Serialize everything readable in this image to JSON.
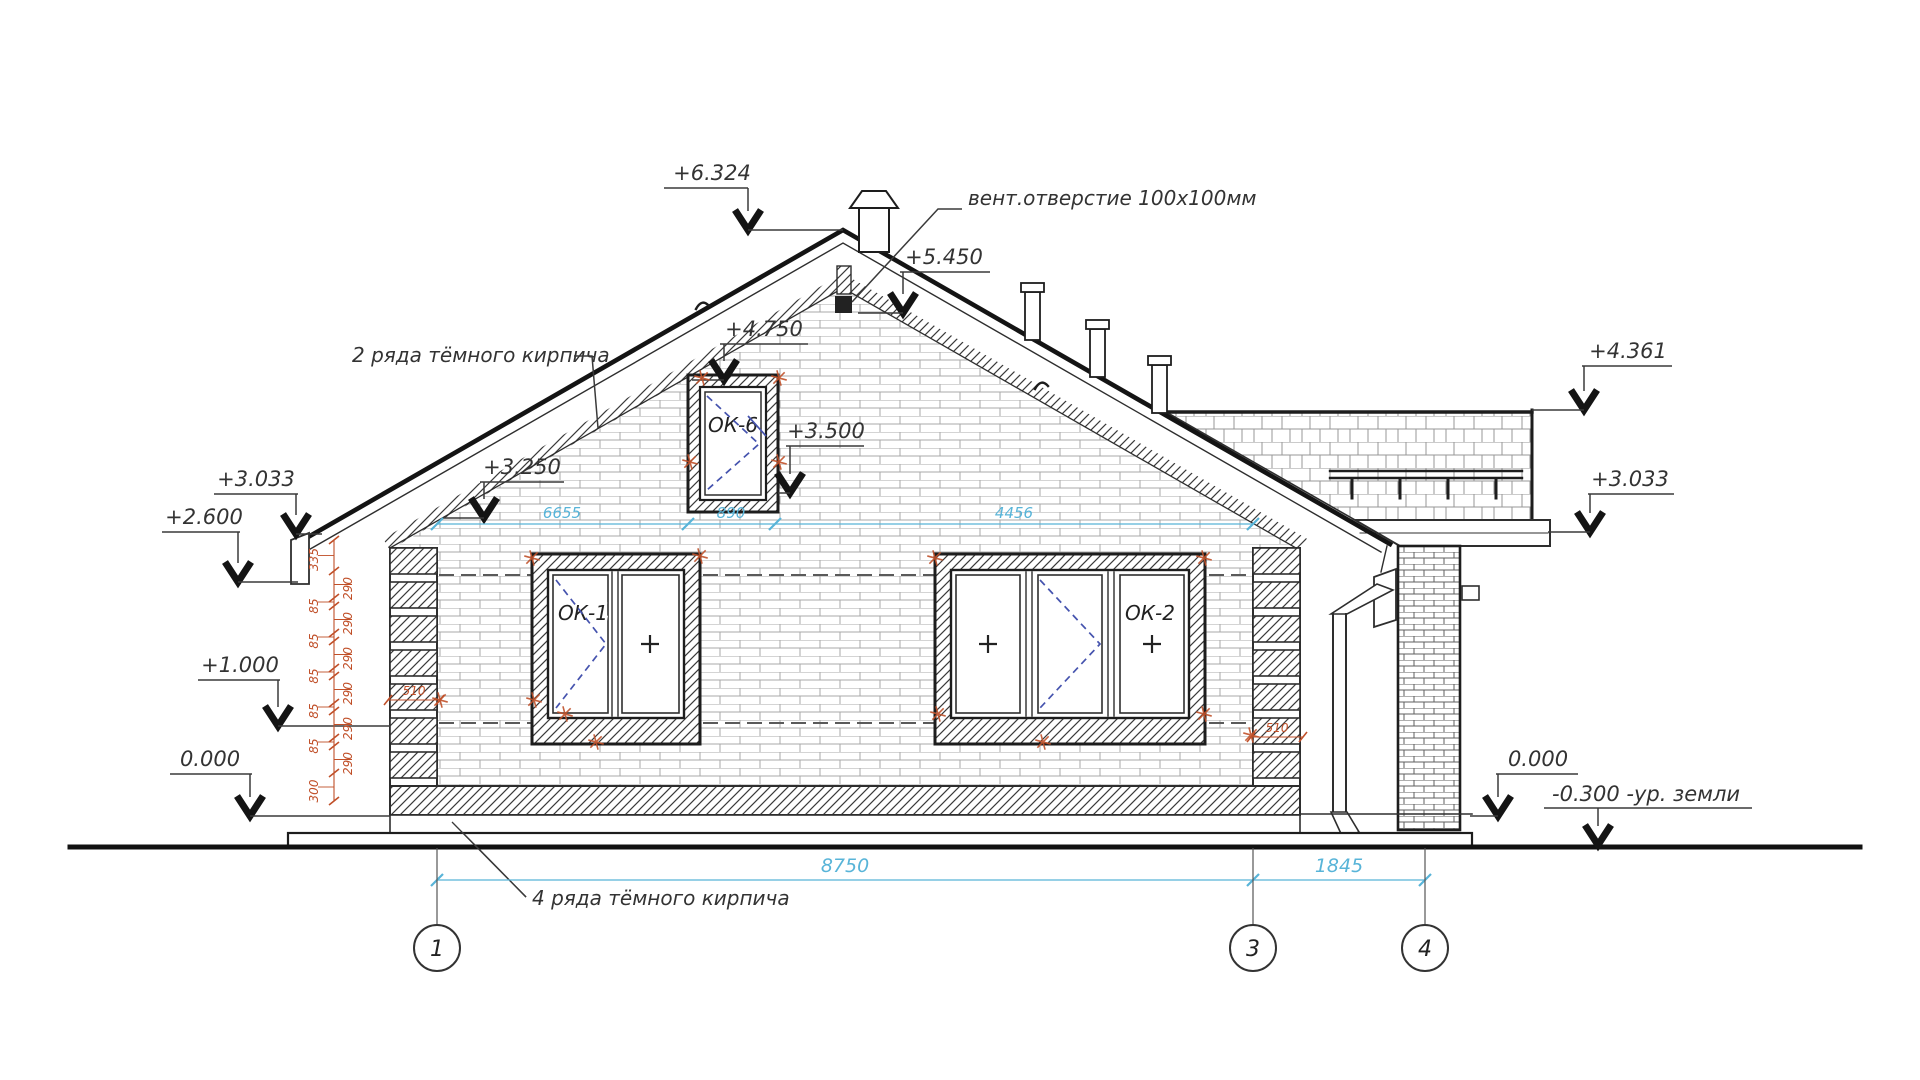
{
  "labels": {
    "vent": "вент.отверстие 100х100мм",
    "dark_brick_2": "2 ряда тёмного кирпича",
    "dark_brick_4": "4 ряда тёмного кирпича",
    "ground_level": "-0.300 -ур. земли"
  },
  "elevation_marks": [
    {
      "id": "m6324",
      "label": "+6.324"
    },
    {
      "id": "m5450",
      "label": "+5.450"
    },
    {
      "id": "m4750",
      "label": "+4.750"
    },
    {
      "id": "m3500",
      "label": "+3.500"
    },
    {
      "id": "m3250",
      "label": "+3.250"
    },
    {
      "id": "m3033L",
      "label": "+3.033"
    },
    {
      "id": "m2600",
      "label": "+2.600"
    },
    {
      "id": "m1000",
      "label": "+1.000"
    },
    {
      "id": "m0000L",
      "label": "0.000"
    },
    {
      "id": "m4361",
      "label": "+4.361"
    },
    {
      "id": "m3033R",
      "label": "+3.033"
    },
    {
      "id": "m0000R",
      "label": "0.000"
    }
  ],
  "windows": [
    {
      "id": "ok1",
      "label": "ОК-1"
    },
    {
      "id": "ok2",
      "label": "ОК-2"
    },
    {
      "id": "ok6",
      "label": "ОК-6"
    }
  ],
  "dimensions": {
    "top": [
      "6655",
      "890",
      "4456"
    ],
    "bottom": [
      "8750",
      "1845"
    ],
    "left_chain": [
      "335",
      "290",
      "85",
      "290",
      "85",
      "290",
      "85",
      "290",
      "85",
      "290",
      "85",
      "290",
      "300"
    ],
    "quoin_width": [
      "510",
      "510"
    ]
  },
  "axes": [
    "1",
    "3",
    "4"
  ],
  "colors": {
    "dimension_blue": "#58b4d8",
    "annotation_red": "#c04f28",
    "line_dark": "#2e2e2e",
    "window_symbol_blue": "#4553ae"
  }
}
